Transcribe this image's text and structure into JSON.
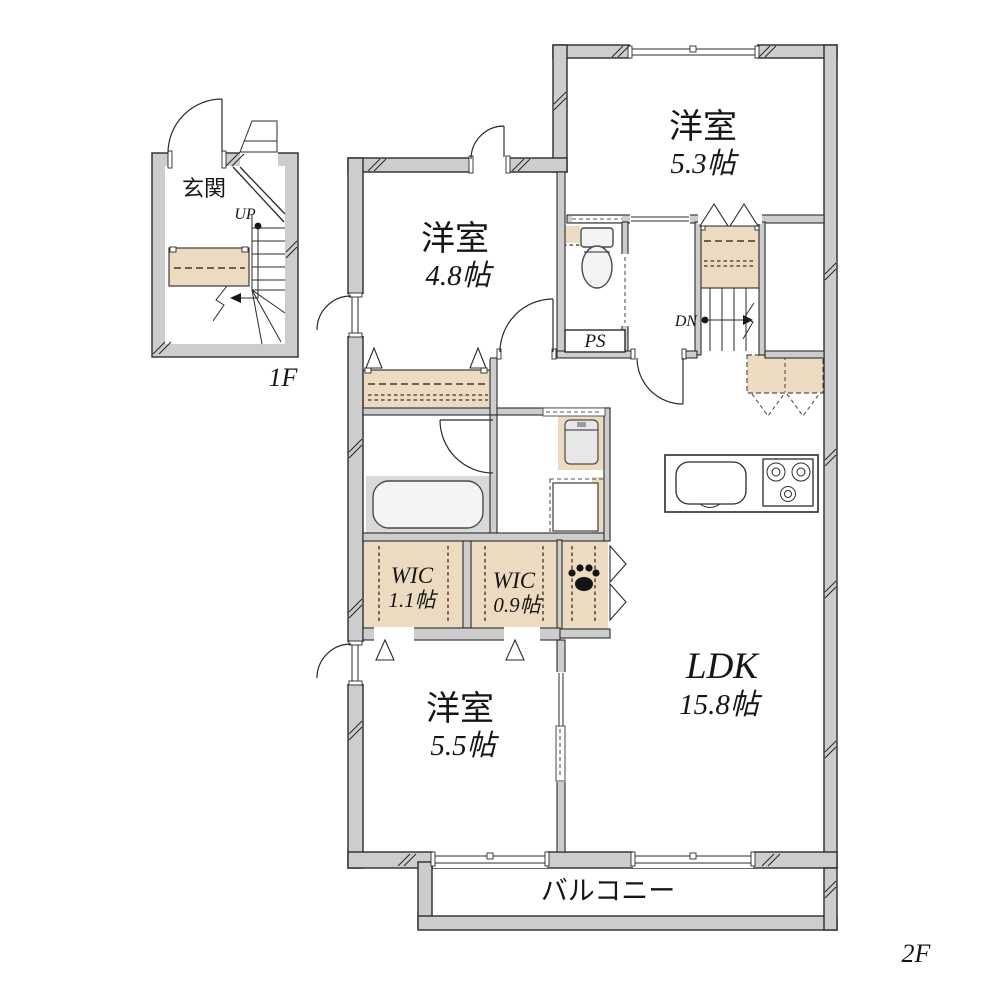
{
  "plan_type": "floor-plan",
  "floor1": {
    "floor_label": "1F",
    "entrance_label": "玄関",
    "stairs_label": "UP"
  },
  "floor2": {
    "floor_label": "2F",
    "stairs_label": "DN",
    "pipe_space_label": "PS",
    "balcony_label": "バルコニー",
    "rooms": [
      {
        "name": "洋室",
        "size": "5.3帖"
      },
      {
        "name": "洋室",
        "size": "4.8帖"
      },
      {
        "name": "洋室",
        "size": "5.5帖"
      },
      {
        "name": "LDK",
        "size": "15.8帖"
      },
      {
        "name": "WIC",
        "size": "1.1帖"
      },
      {
        "name": "WIC",
        "size": "0.9帖"
      }
    ]
  },
  "icons": [
    "paw-print-icon",
    "toilet-icon",
    "bathtub-icon",
    "kitchen-sink-icon",
    "stove-icon",
    "washbasin-icon",
    "washing-machine-icon"
  ],
  "colors": {
    "wall_fill": "#cdcdcd",
    "closet_fill": "#ecdbc0",
    "line": "#2b2b2b",
    "bath_floor": "#d9d9d9",
    "background": "#ffffff"
  }
}
